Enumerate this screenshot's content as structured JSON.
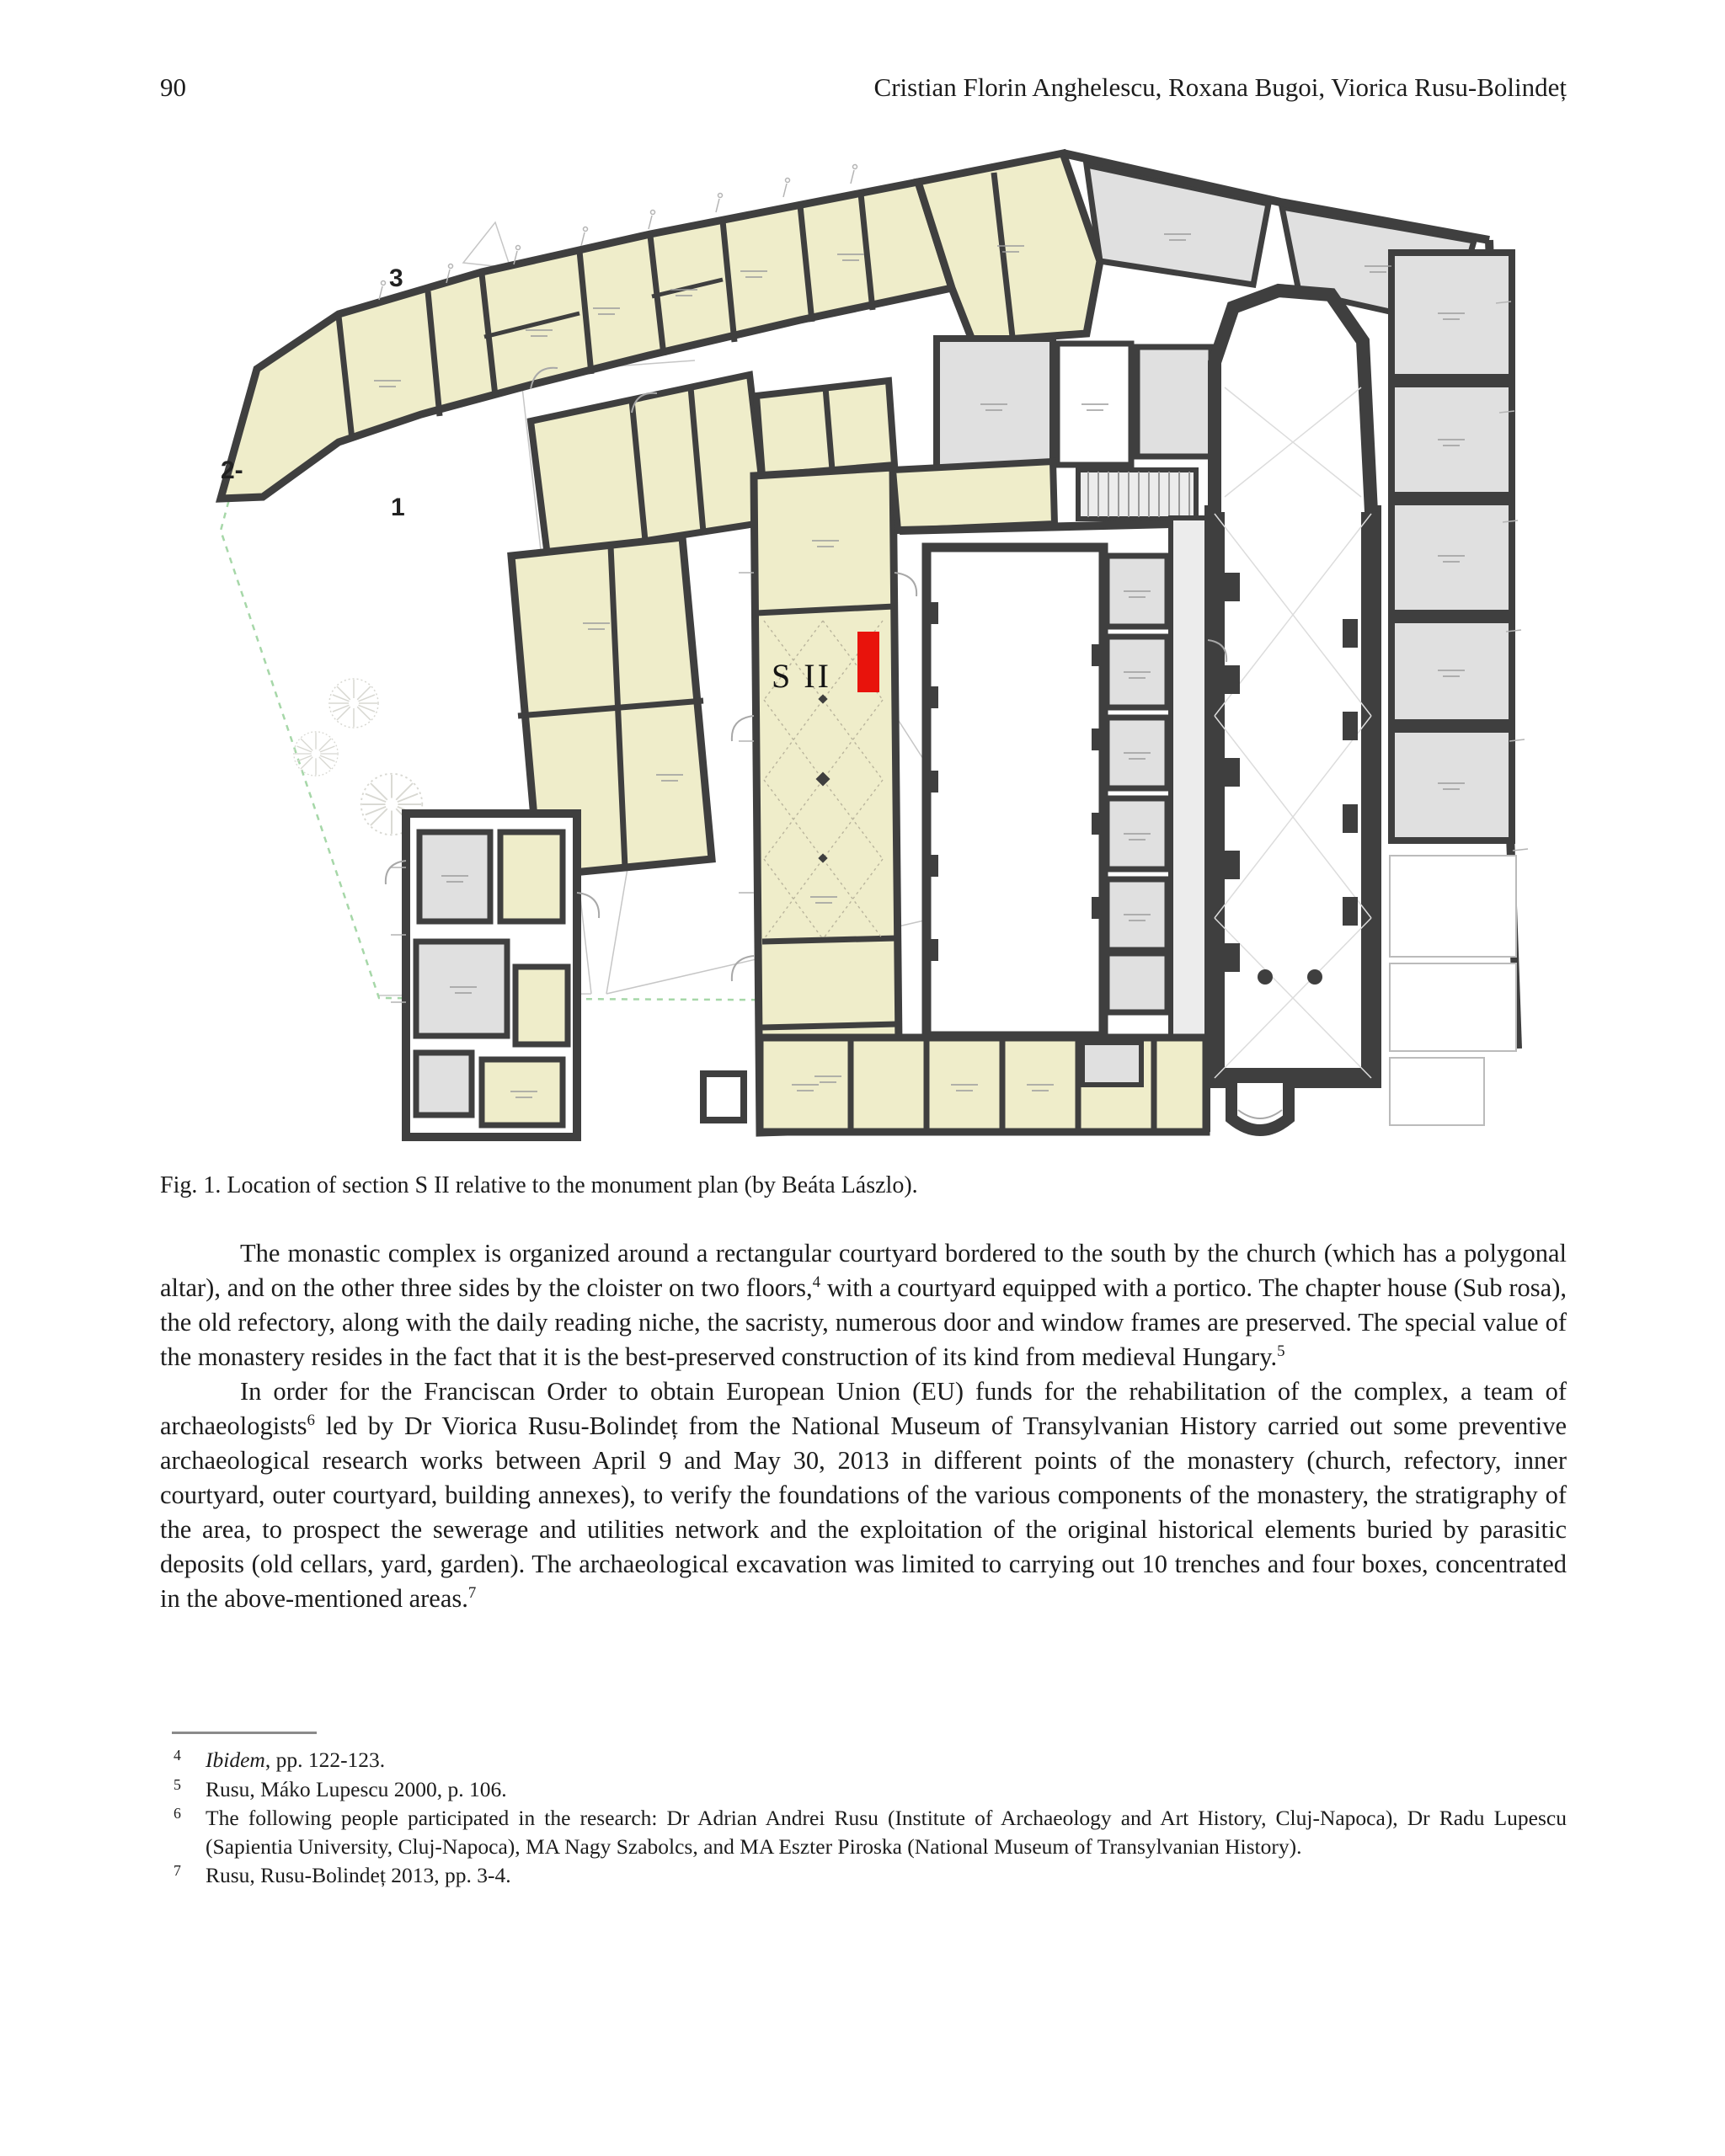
{
  "page": {
    "number": "90",
    "running_header": "Cristian Florin Anghelescu, Roxana Bugoi, Viorica Rusu-Bolindeț"
  },
  "figure": {
    "caption": "Fig. 1. Location of section S II relative to the monument plan (by Beáta Lászlo).",
    "labels": {
      "building3": "3",
      "building2": "2-",
      "area1": "1",
      "section": "S II"
    },
    "colors": {
      "wall": "#3f3f3f",
      "room_cream": "#efedca",
      "room_gray": "#e0e0e0",
      "highlight_red": "#e8130c",
      "boundary_green": "#a6d7a8"
    }
  },
  "body": {
    "paragraphs": [
      {
        "segments": [
          [
            "text",
            "The monastic complex is organized around a rectangular courtyard bordered to the south by the church (which has a polygonal altar), and on the other three sides by the cloister on two floors,"
          ],
          [
            "sup",
            "4"
          ],
          [
            "text",
            " with a courtyard equipped with a portico. The chapter house (Sub rosa), the old refectory, along with the daily reading niche, the sacristy, numerous door and window frames are preserved. The special value of the monastery resides in the fact that it is the best-preserved construction of its kind from medieval Hungary."
          ],
          [
            "sup",
            "5"
          ]
        ]
      },
      {
        "segments": [
          [
            "text",
            "In order for the Franciscan Order to obtain European Union (EU) funds for the rehabilitation of the complex, a team of archaeologists"
          ],
          [
            "sup",
            "6"
          ],
          [
            "text",
            " led by Dr Viorica Rusu-Bolindeț from the National Museum of Transylvanian History carried out some preventive archaeological research works between April 9 and May 30, 2013 in different points of the monastery (church, refectory, inner courtyard, outer courtyard, building annexes), to verify the foundations of the various components of the monastery, the stratigraphy of the area, to prospect the sewerage and utilities network and the exploitation of the original historical elements buried by parasitic deposits (old cellars, yard, garden). The archaeological excavation was limited to carrying out 10 trenches and four boxes, concentrated in the above-mentioned areas."
          ],
          [
            "sup",
            "7"
          ]
        ]
      }
    ]
  },
  "footnotes": [
    {
      "num": "4",
      "segments": [
        [
          "italic",
          "Ibidem"
        ],
        [
          "text",
          ", pp. 122-123."
        ]
      ]
    },
    {
      "num": "5",
      "segments": [
        [
          "text",
          "Rusu, Máko Lupescu 2000, p. 106."
        ]
      ]
    },
    {
      "num": "6",
      "segments": [
        [
          "text",
          "The following people participated in the research: Dr Adrian Andrei Rusu (Institute of Archaeology and Art History, Cluj-Napoca), Dr Radu Lupescu (Sapientia University, Cluj-Napoca), MA Nagy Szabolcs, and MA Eszter Piroska (National Museum of Transylvanian History)."
        ]
      ]
    },
    {
      "num": "7",
      "segments": [
        [
          "text",
          "Rusu, Rusu-Bolindeț 2013, pp. 3-4."
        ]
      ]
    }
  ]
}
